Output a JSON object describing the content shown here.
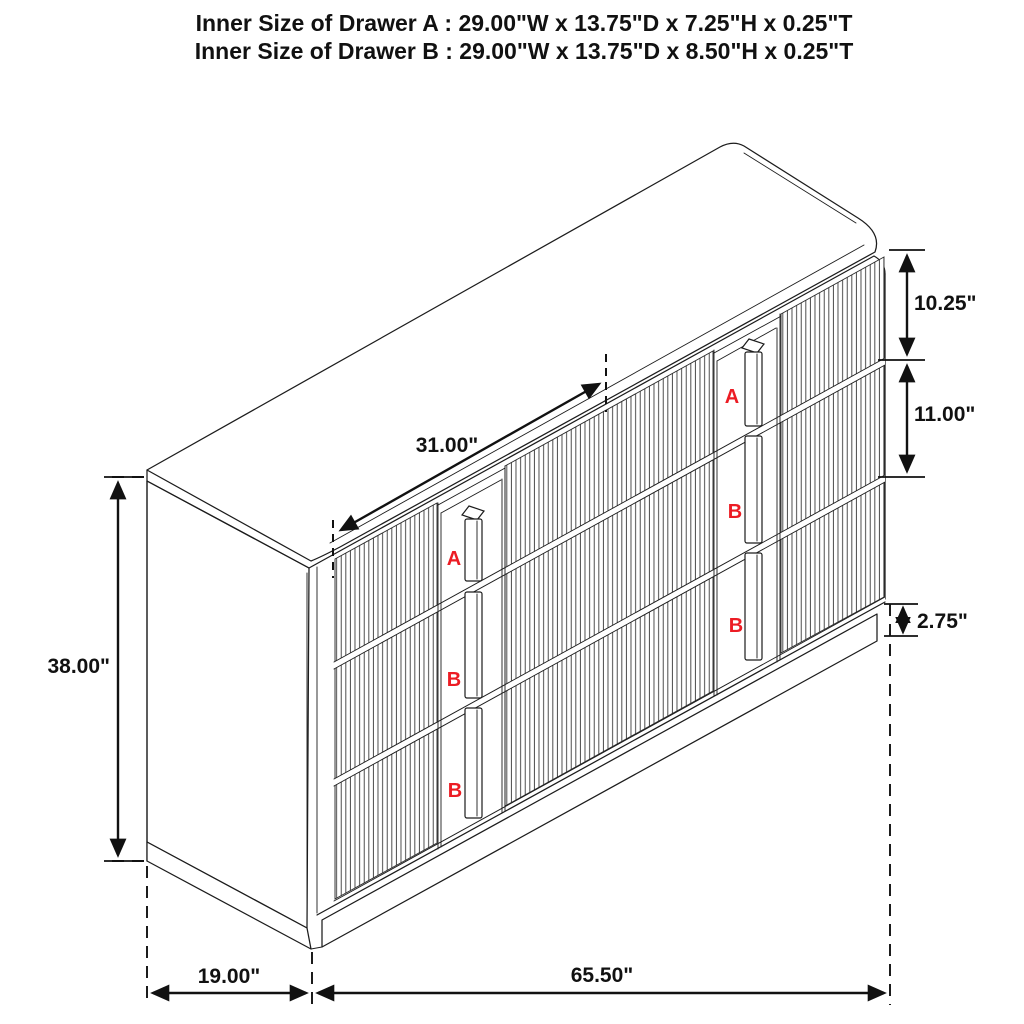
{
  "title": {
    "line1": "Inner Size of Drawer A : 29.00\"W x 13.75\"D x 7.25\"H x 0.25\"T",
    "line2": "Inner Size of Drawer B : 29.00\"W x 13.75\"D x 8.50\"H x 0.25\"T"
  },
  "dimensions": {
    "overall_height": "38.00\"",
    "top_diagonal_depth": "31.00\"",
    "top_drawer_height": "10.25\"",
    "middle_drawer_height": "11.00\"",
    "base_height": "2.75\"",
    "side_depth": "19.00\"",
    "front_width": "65.50\""
  },
  "drawer_labels": {
    "left_top": "A",
    "left_middle": "B",
    "left_bottom": "B",
    "right_top": "A",
    "right_middle": "B",
    "right_bottom": "B"
  },
  "colors": {
    "line": "#1c1c1c",
    "label_red": "#ec1c24",
    "background": "#ffffff"
  }
}
